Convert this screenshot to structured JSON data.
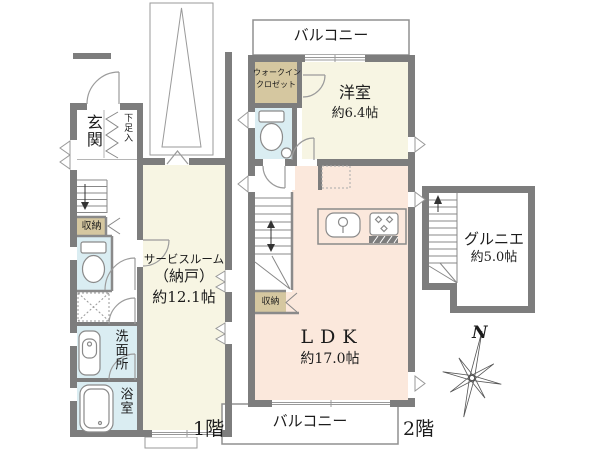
{
  "floor1": {
    "floor_label": "1階",
    "genkan": "玄関",
    "shoe_cabinet": "下足入",
    "storage": "収納",
    "service_room_line1": "サービスルーム",
    "service_room_line2": "（納戸）",
    "service_room_size": "約12.1帖",
    "washroom": "洗面所",
    "bathroom": "浴室"
  },
  "floor2": {
    "floor_label": "2階",
    "balcony_top": "バルコニー",
    "balcony_bottom": "バルコニー",
    "wic_line1": "ウォークイン",
    "wic_line2": "クロゼット",
    "western_room": "洋室",
    "western_room_size": "約6.4帖",
    "storage": "収納",
    "ldk": "LDK",
    "ldk_size": "約17.0帖"
  },
  "attic": {
    "name": "グルニエ",
    "size": "約5.0帖"
  },
  "compass": {
    "north": "N"
  },
  "colors": {
    "wall": "#7d7d7d",
    "room_cream": "#f7f5e3",
    "room_pink": "#fbe8dc",
    "room_tan": "#d5c7a0",
    "room_blue": "#daedf2",
    "line": "#8a8a8a"
  }
}
